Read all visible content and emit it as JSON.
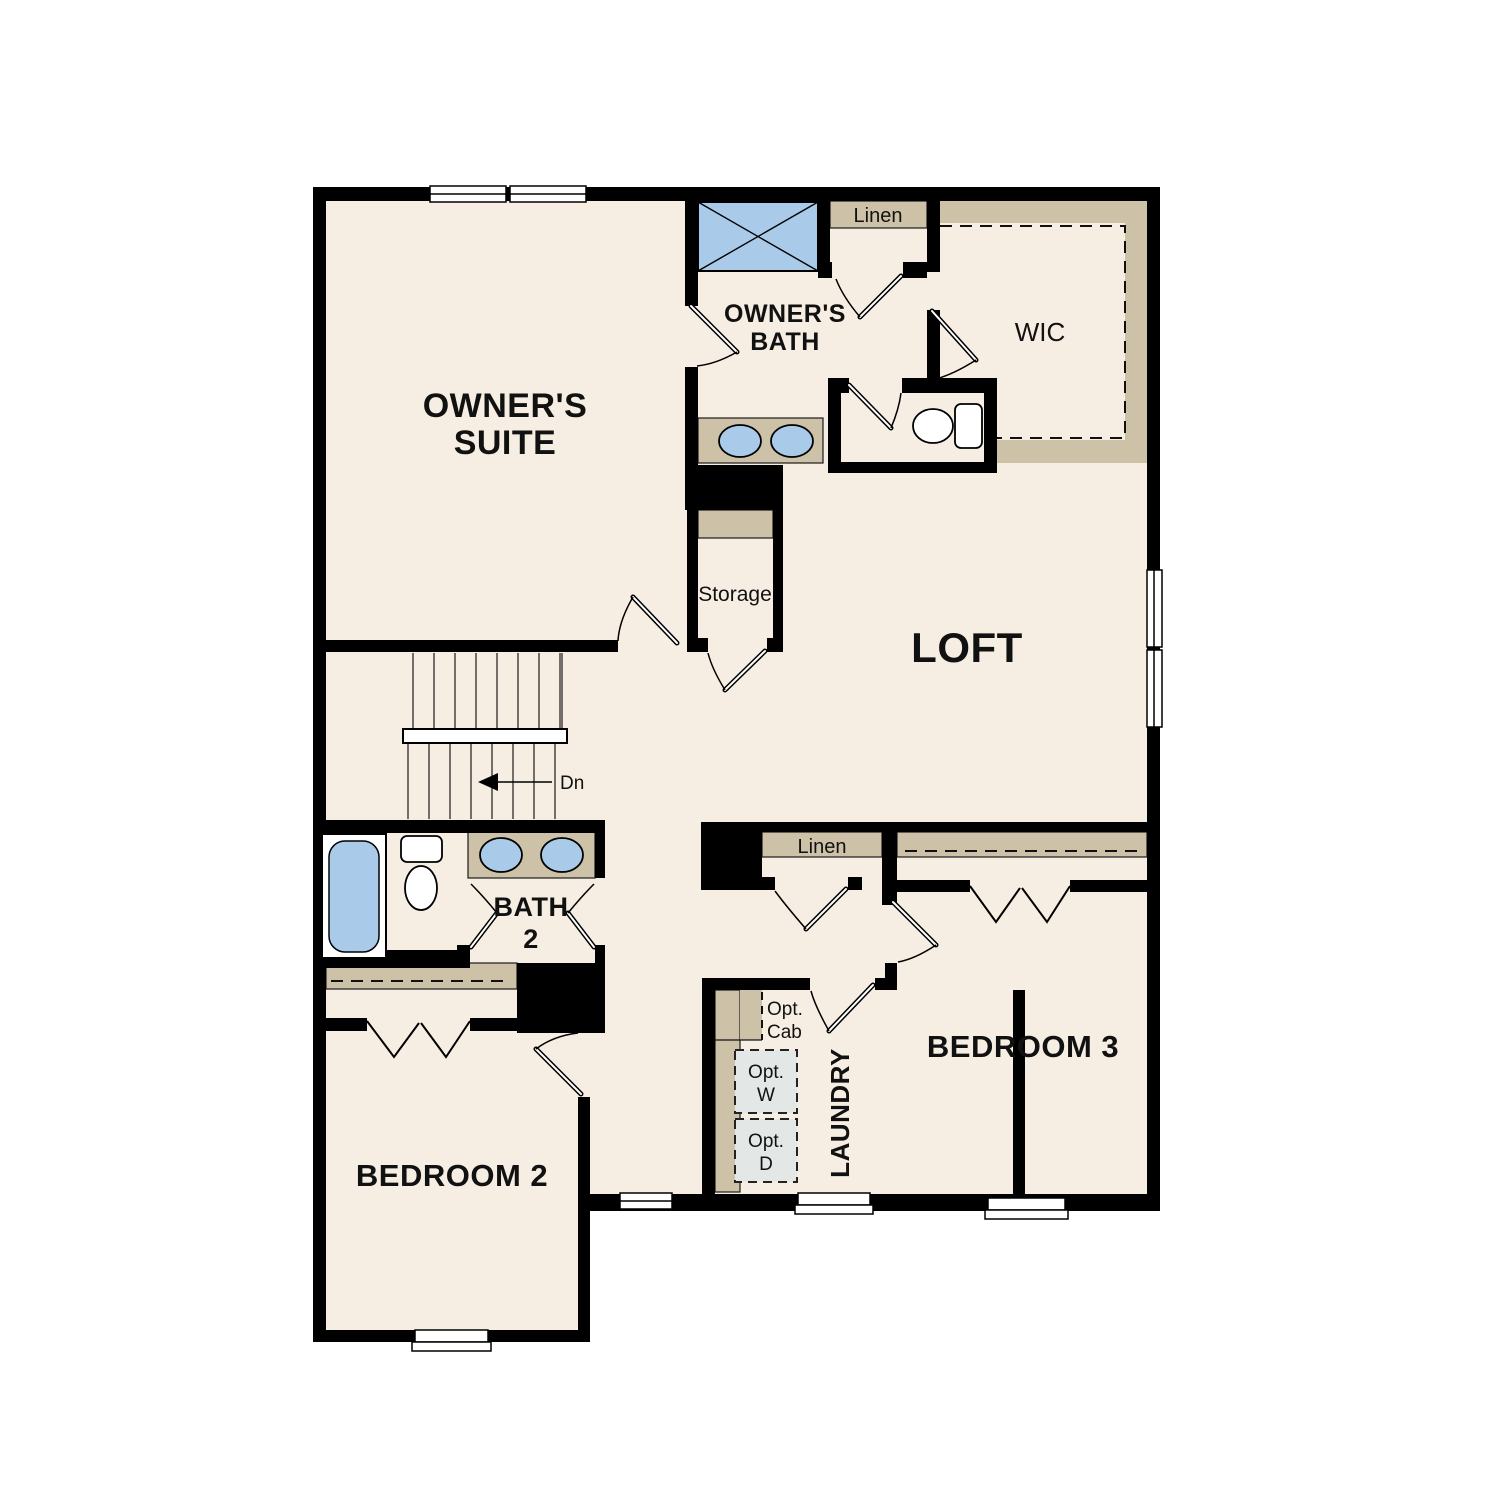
{
  "colors": {
    "floor": "#F7EEE3",
    "shelf_tan": "#CDC2A8",
    "wall": "#000000",
    "fixture_blue": "#A9CAE9",
    "appliance_gray": "#E3E8E7",
    "window_fill": "#FFFFFF"
  },
  "rooms": {
    "owners_suite": {
      "line1": "OWNER'S",
      "line2": "SUITE"
    },
    "owners_bath": {
      "line1": "OWNER'S",
      "line2": "BATH"
    },
    "wic": {
      "label": "WIC"
    },
    "linen_top": {
      "label": "Linen"
    },
    "storage": {
      "label": "Storage"
    },
    "loft": {
      "label": "LOFT"
    },
    "stairs": {
      "down_label": "Dn"
    },
    "bath2": {
      "line1": "BATH",
      "line2": "2"
    },
    "linen_hall": {
      "label": "Linen"
    },
    "bedroom2": {
      "label": "BEDROOM 2"
    },
    "bedroom3": {
      "label": "BEDROOM 3"
    },
    "laundry": {
      "label": "LAUNDRY",
      "opt_cab_line1": "Opt.",
      "opt_cab_line2": "Cab",
      "opt_w_line1": "Opt.",
      "opt_w_line2": "W",
      "opt_d_line1": "Opt.",
      "opt_d_line2": "D"
    }
  }
}
